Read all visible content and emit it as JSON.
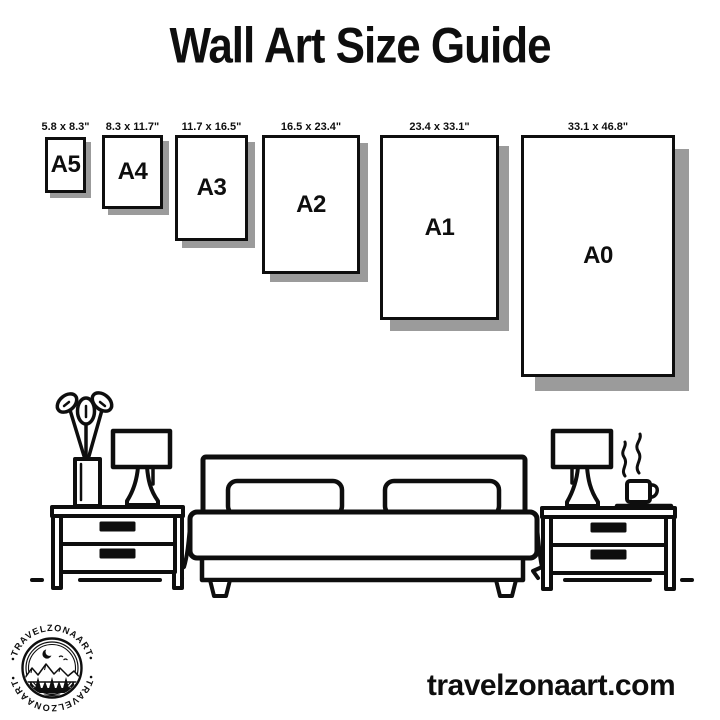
{
  "page": {
    "title": "Wall Art Size Guide",
    "website": "travelzonaart.com"
  },
  "colors": {
    "ink": "#0e0e0e",
    "frame_shadow": "#9b9b9b",
    "background": "#ffffff"
  },
  "sizes": [
    {
      "name": "A5",
      "dimensions": "5.8 x 8.3\""
    },
    {
      "name": "A4",
      "dimensions": "8.3 x 11.7\""
    },
    {
      "name": "A3",
      "dimensions": "11.7 x 16.5\""
    },
    {
      "name": "A2",
      "dimensions": "16.5 x 23.4\""
    },
    {
      "name": "A1",
      "dimensions": "23.4 x 33.1\""
    },
    {
      "name": "A0",
      "dimensions": "33.1 x 46.8\""
    }
  ],
  "logo": {
    "top_text": "•TRAVELZONAART•",
    "bottom_text": "•TRAVELZONAART•"
  },
  "illustration": {
    "elements": [
      "plant-vase-icon",
      "table-lamp-icon",
      "bed-icon",
      "pillow-icon",
      "nightstand-icon",
      "coffee-cup-icon",
      "steam-icon",
      "floor-line"
    ]
  }
}
